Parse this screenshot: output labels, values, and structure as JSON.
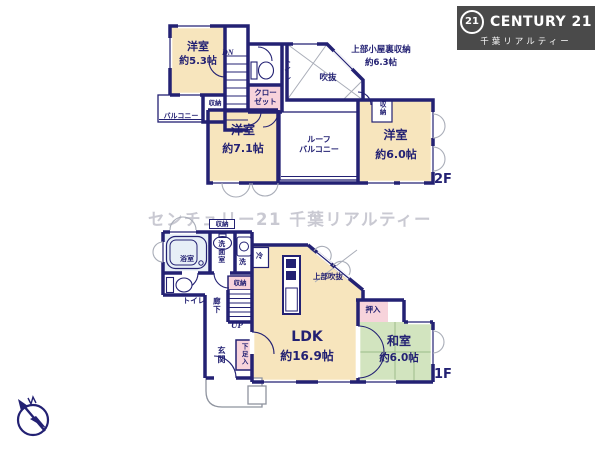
{
  "logo": {
    "mark": "21",
    "brand": "CENTURY 21",
    "subtitle": "千葉リアルティー"
  },
  "watermark": "センチュリー21 千葉リアルティー",
  "colors": {
    "wall": "#232173",
    "room_tan": "#f7e5bd",
    "closet_pink": "#f7d3db",
    "tatami_green": "#d2e4bf",
    "bath_blue": "#e7eff7",
    "logo_bg": "#4a4a4a",
    "watermark_gray": "#c9c9d2"
  },
  "floor2": {
    "label": "2F",
    "rooms": {
      "yoshitsu_53": {
        "name": "洋室",
        "size": "約5.3帖"
      },
      "yoshitsu_71": {
        "name": "洋室",
        "size": "約7.1帖"
      },
      "yoshitsu_60": {
        "name": "洋室",
        "size": "約6.0帖"
      },
      "attic": {
        "name": "上部小屋裏収納",
        "size": "約6.3帖"
      },
      "void": {
        "name": "吹抜"
      },
      "roof_balcony": {
        "name": "ルーフ\nバルコニー"
      },
      "balcony": {
        "name": "バルコニー"
      },
      "closet": {
        "name": "クロー\nゼット"
      },
      "toilet": {
        "name": "トイレ"
      },
      "storage_left": {
        "name": "収納"
      },
      "storage_right": {
        "name": "収納"
      },
      "stairs_down": {
        "name": "DN"
      }
    }
  },
  "floor1": {
    "label": "1F",
    "rooms": {
      "ldk": {
        "name": "LDK",
        "size": "約16.9帖"
      },
      "washitsu": {
        "name": "和室",
        "size": "約6.0帖"
      },
      "genkan": {
        "name": "玄関"
      },
      "bathroom": {
        "name": "浴室"
      },
      "washroom": {
        "name": "洗面室"
      },
      "toilet": {
        "name": "トイレ"
      },
      "hallway": {
        "name": "廊下"
      },
      "stairs_up": {
        "name": "UP"
      },
      "oshiire": {
        "name": "押入"
      },
      "storage_hall": {
        "name": "収納"
      },
      "storage_top": {
        "name": "収納"
      },
      "shoe_box": {
        "name": "下足入"
      },
      "void_above": {
        "name": "上部吹抜"
      },
      "refrigerator": {
        "name": "冷"
      },
      "washer": {
        "name": "洗"
      }
    }
  }
}
